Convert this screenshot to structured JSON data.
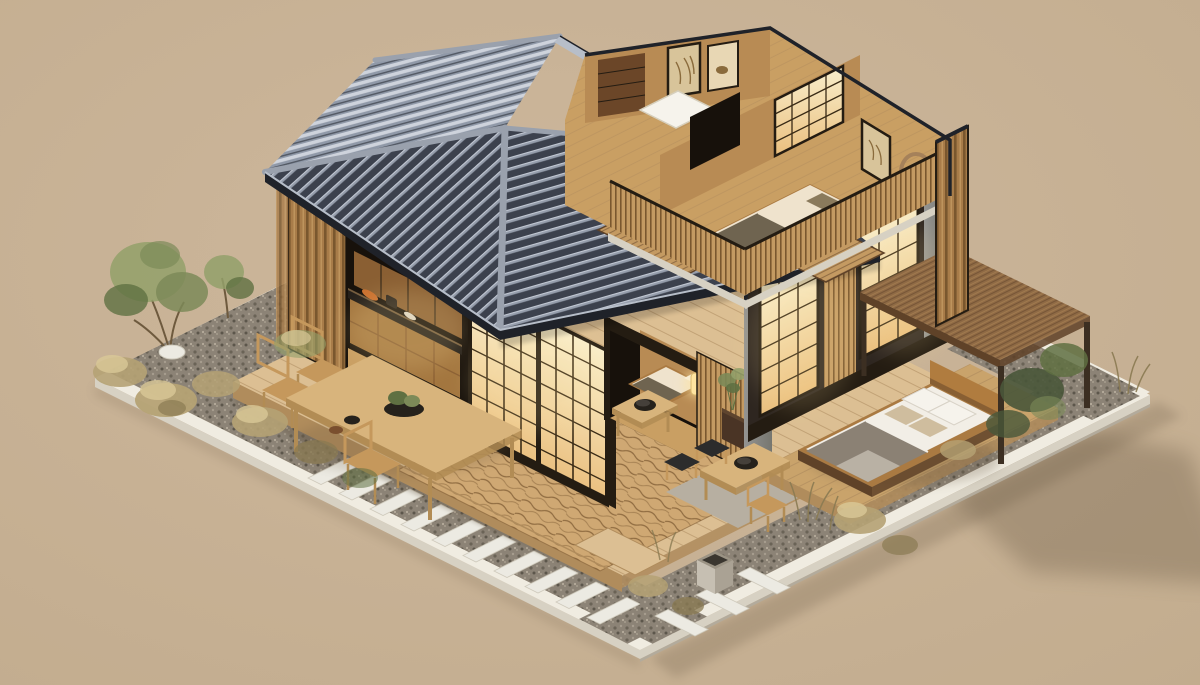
{
  "alt": "Isometric 3D rendering of a modern Japanese-style wooden house with a cutaway view: dark tiled hip roof, glowing shoji screens, open kitchen, upper-floor bedroom and study without roof, engawa wood deck with dining table, zen gravel garden with white stepping stones, dry shrubs and green trees, and an outdoor bed under a flat wooden pergola, all on a tan background.",
  "palette": {
    "bg1": "#cdb79c",
    "bg2": "#c2ac8e",
    "shadow": "#5e4f3a",
    "curb": "#f0ece1",
    "curbSide": "#d7d1c3",
    "curbShade": "#b3ab9c",
    "gravel": "#8c8376",
    "gravelDark": "#6a6356",
    "gravelDark2": "#5c564b",
    "gravelLight": "#a69d8e",
    "gravelLight2": "#b5ab9b",
    "deck": "#dcbf93",
    "deckSide": "#b08c5c",
    "plankLine": "#a8855a",
    "mat": "#cfa873",
    "waveLine": "#7e5b33",
    "roofDark": "#3c414d",
    "roofTile": "#959dab",
    "roofTileHi": "#c2c8d3",
    "roofBack": "#9099a8",
    "roofBackHi": "#ced3dc",
    "roofCap": "#9aa1ad",
    "fascia": "#1f2229",
    "fasciaHi": "#b7bec9",
    "slatBase": "#a87c49",
    "slatDark": "#7a572e",
    "slatHi": "#c49a62",
    "shoji1": "#f9efcd",
    "shoji2": "#eabf7e",
    "mullion": "#3a2b16",
    "frameDark": "#241c12",
    "cabinet": "#8a5f33",
    "cabinet2": "#a3763f",
    "counter": "#241f1a",
    "floorIn": "#c99f63",
    "wallIn": "#b88b54",
    "recessDark": "#17110b",
    "grayCol": "#949492",
    "grayColDark": "#76766f",
    "canopy": "#8f6a45",
    "canopySide": "#5f4228",
    "postDark": "#3c2f22",
    "concrete1": "#c6bfb2",
    "concrete2": "#aaa294",
    "pad": "#b7afa1",
    "platform": "#c9a36b",
    "bedFrame": "#aa7a42",
    "mattress": "#f2eee6",
    "blanket": "#8b8174",
    "blanketLight": "#b9b1a4",
    "pillow": "#f6f3ec",
    "cushion": "#cfbd9e",
    "headboard": "#b07c3f",
    "oliveBlanket": "#6f6450",
    "bedCream": "#efe3cd",
    "green1": "#7c8a58",
    "green2": "#5f7042",
    "green3": "#93a06a",
    "greenDark": "#49573a",
    "dry1": "#b5a274",
    "dry2": "#8a7a52",
    "dry3": "#d9c897",
    "stone": "#eceae2",
    "stoneEdge": "#cfcabc",
    "table": "#d8b47c",
    "tableSide": "#b28c54",
    "chair": "#c5985c",
    "bowlDark": "#26221c",
    "lampGlow": "#ffe4a0"
  },
  "scene": {
    "style": "isometric architectural cutaway render",
    "setting": "tan studio backdrop",
    "elements": [
      {
        "name": "plot-curb",
        "description": "white stone curb framing the rectangular lot"
      },
      {
        "name": "gravel-beds",
        "description": "dark gravel strips along the curb with shrubs"
      },
      {
        "name": "stepping-stones",
        "description": "white rectangular pavers crossing the gravel path"
      },
      {
        "name": "wood-deck",
        "description": "large engawa timber deck around the house"
      },
      {
        "name": "zen-mat",
        "description": "raked wave-grain mat area on the deck"
      },
      {
        "name": "hip-roof",
        "description": "dark blue-gray tiled hip roof over the left wing"
      },
      {
        "name": "kitchen-cutaway",
        "description": "open kitchen with wood cabinets and dark counter"
      },
      {
        "name": "shoji-walls",
        "description": "warm glowing shoji paper screens with dark mullions"
      },
      {
        "name": "slat-walls",
        "description": "vertical timber slat cladding"
      },
      {
        "name": "futon-nook",
        "description": "recessed tatami room with futon, paper floor lamp and potted plant"
      },
      {
        "name": "upper-floor-cutaway",
        "description": "roofless upper level showing bedroom and study"
      },
      {
        "name": "upper-bedroom",
        "description": "bed with olive blanket, wall art and round wreath"
      },
      {
        "name": "upper-study",
        "description": "white sleeping mat, dark cabinet and art alcove"
      },
      {
        "name": "balcony-fence",
        "description": "thin bamboo slat balustrades on the open level"
      },
      {
        "name": "right-wing",
        "description": "lower wing with two lit shoji windows"
      },
      {
        "name": "pergola-canopy",
        "description": "flat wooden canopy on dark posts"
      },
      {
        "name": "outdoor-bed",
        "description": "platform bed with white and gray bedding and four pillows"
      },
      {
        "name": "concrete-steps",
        "description": "wide light-gray steps to the bed platform"
      },
      {
        "name": "dining-set",
        "description": "light wood dining table with three chairs and bowls"
      },
      {
        "name": "tea-tables",
        "description": "two low tables with black bowls, small stools"
      },
      {
        "name": "planter-box",
        "description": "small concrete planter cube"
      },
      {
        "name": "green-trees",
        "description": "leafy green trees in the left garden corner"
      },
      {
        "name": "dry-shrubs",
        "description": "golden dry bushes and grasses along the gravel"
      },
      {
        "name": "ground-shadow",
        "description": "soft cast shadow on the backdrop to the right"
      }
    ]
  }
}
